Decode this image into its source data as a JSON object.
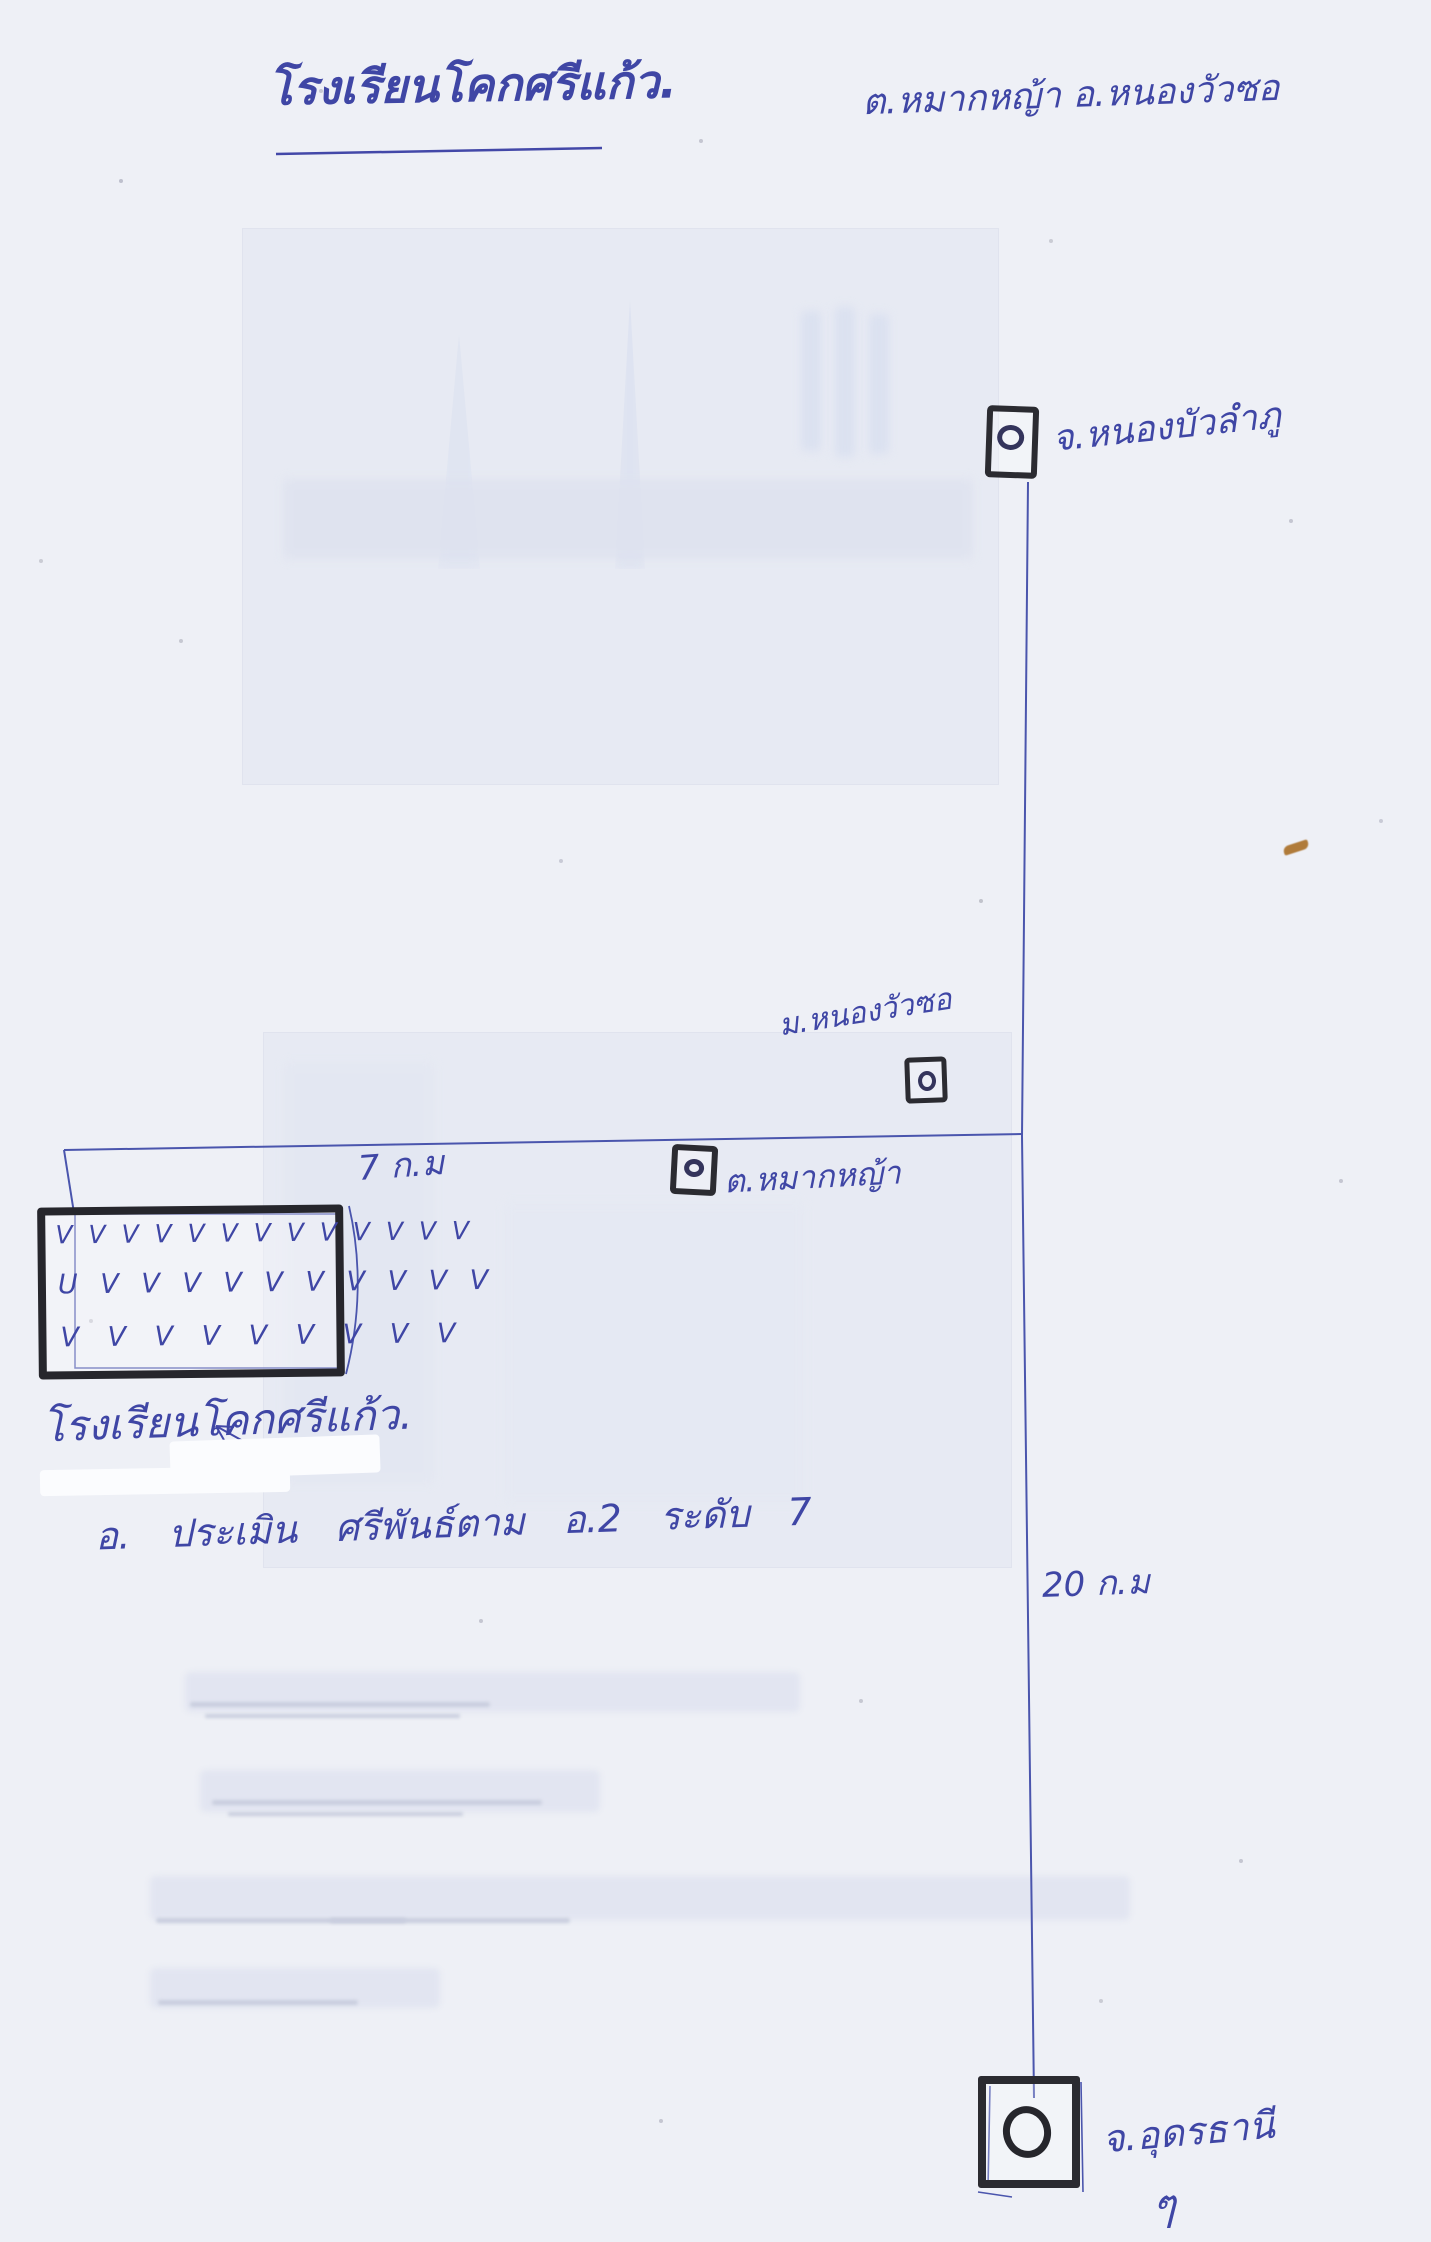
{
  "title": {
    "school": "โรงเรียนโคกศรีแก้ว.",
    "location": "ต.หมากหญ้า  อ.หนองวัวซอ"
  },
  "landmarks": {
    "nong_bua_lamphu": "จ.หนองบัวลำภู",
    "nong_wua_so": "ม.หนองวัวซอ",
    "mak_ya": "ต.หมากหญ้า",
    "udon_thani": "จ.อุดรธานี",
    "udon_thani_mark": "ๆ"
  },
  "distances": {
    "school_junction": "7 ก.ม",
    "junction_udon": "20 ก.ม"
  },
  "school": {
    "caption": "โรงเรียนโคกศรีแก้ว.",
    "hatch_rows": [
      "V V V V V V V V V V V V V",
      "U V V V V V V V V V V",
      "V V V V V V V V V"
    ]
  },
  "note": "อ. ประเมิน ศรีพันธ์ตาม อ.2 ระดับ 7",
  "colors": {
    "ink_blue": "#3f46a5",
    "marker_black": "#2b2b31",
    "paper": "#eef0f6"
  }
}
